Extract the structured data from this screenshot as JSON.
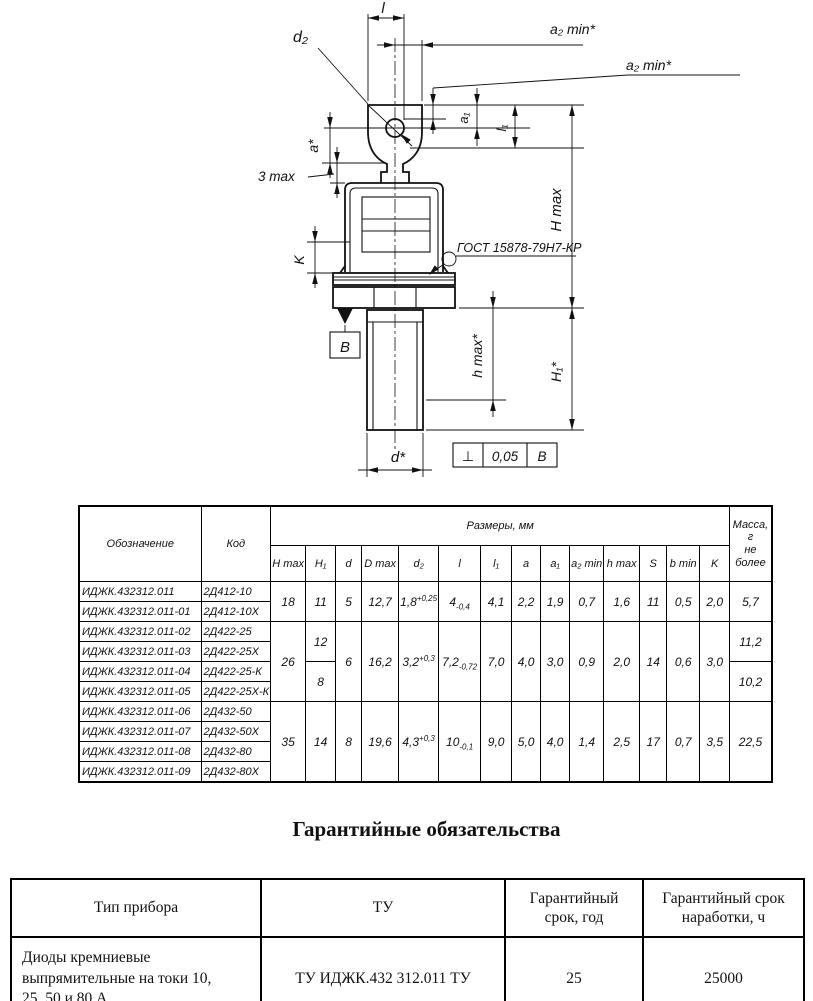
{
  "drawing": {
    "labels": {
      "l": "l",
      "a2_min_top": "a₂ min*",
      "a2_min_side": "a₂ min*",
      "d2": "d₂",
      "a1": "a₁",
      "l1": "l₁",
      "a_star": "a*",
      "three_max": "3 max",
      "k": "K",
      "gost": "ГОСТ 15878-79Н7-КР",
      "datum_b": "В",
      "h_max_star": "h max*",
      "h1_star": "H₁*",
      "h_max_total": "H max",
      "d_star": "d*"
    },
    "tolerance_frame": {
      "symbol": "⊥",
      "value": "0,05",
      "datum": "В"
    }
  },
  "dims_table": {
    "headers": {
      "designation": "Обозначение",
      "code": "Код",
      "sizes": "Размеры, мм",
      "mass": "Масса, г\nне более",
      "columns": [
        "H max",
        "H₁",
        "d",
        "D max",
        "d₂",
        "l",
        "l₁",
        "a",
        "a₁",
        "a₂ min",
        "h max",
        "S",
        "b min",
        "K"
      ]
    },
    "col_widths": [
      122,
      56,
      35,
      30,
      26,
      37,
      40,
      42,
      31,
      29,
      29,
      33,
      36,
      27,
      33,
      30,
      42
    ],
    "rows": [
      {
        "cells": [
          {
            "t": "ИДЖК.432312.011"
          },
          {
            "t": "2Д412-10"
          },
          {
            "t": "18",
            "rs": 2
          },
          {
            "t": "11",
            "rs": 2
          },
          {
            "t": "5",
            "rs": 2
          },
          {
            "t": "12,7",
            "rs": 2
          },
          {
            "t": "1,8",
            "sup": "+0,25",
            "rs": 2
          },
          {
            "t": "4",
            "sub": "-0,4",
            "rs": 2
          },
          {
            "t": "4,1",
            "rs": 2
          },
          {
            "t": "2,2",
            "rs": 2
          },
          {
            "t": "1,9",
            "rs": 2
          },
          {
            "t": "0,7",
            "rs": 2
          },
          {
            "t": "1,6",
            "rs": 2
          },
          {
            "t": "11",
            "rs": 2
          },
          {
            "t": "0,5",
            "rs": 2
          },
          {
            "t": "2,0",
            "rs": 2
          },
          {
            "t": "5,7",
            "rs": 2
          }
        ]
      },
      {
        "cells": [
          {
            "t": "ИДЖК.432312.011-01"
          },
          {
            "t": "2Д412-10Х"
          }
        ]
      },
      {
        "cells": [
          {
            "t": "ИДЖК.432312.011-02"
          },
          {
            "t": "2Д422-25"
          },
          {
            "t": "26",
            "rs": 4
          },
          {
            "t": "12",
            "rs": 2
          },
          {
            "t": "6",
            "rs": 4
          },
          {
            "t": "16,2",
            "rs": 4
          },
          {
            "t": "3,2",
            "sup": "+0,3",
            "rs": 4
          },
          {
            "t": "7,2",
            "sub": "-0,72",
            "rs": 4
          },
          {
            "t": "7,0",
            "rs": 4
          },
          {
            "t": "4,0",
            "rs": 4
          },
          {
            "t": "3,0",
            "rs": 4
          },
          {
            "t": "0,9",
            "rs": 4
          },
          {
            "t": "2,0",
            "rs": 4
          },
          {
            "t": "14",
            "rs": 4
          },
          {
            "t": "0,6",
            "rs": 4
          },
          {
            "t": "3,0",
            "rs": 4
          },
          {
            "t": "11,2",
            "rs": 2
          }
        ]
      },
      {
        "cells": [
          {
            "t": "ИДЖК.432312.011-03"
          },
          {
            "t": "2Д422-25Х"
          }
        ]
      },
      {
        "cells": [
          {
            "t": "ИДЖК.432312.011-04"
          },
          {
            "t": "2Д422-25-К"
          },
          {
            "t": "8",
            "rs": 2
          },
          {
            "t": "10,2",
            "rs": 2
          }
        ]
      },
      {
        "cells": [
          {
            "t": "ИДЖК.432312.011-05"
          },
          {
            "t": "2Д422-25Х-К"
          }
        ]
      },
      {
        "cells": [
          {
            "t": "ИДЖК.432312.011-06"
          },
          {
            "t": "2Д432-50"
          },
          {
            "t": "35",
            "rs": 4
          },
          {
            "t": "14",
            "rs": 4
          },
          {
            "t": "8",
            "rs": 4
          },
          {
            "t": "19,6",
            "rs": 4
          },
          {
            "t": "4,3",
            "sup": "+0,3",
            "rs": 4
          },
          {
            "t": "10",
            "sub": "-0,1",
            "rs": 4
          },
          {
            "t": "9,0",
            "rs": 4
          },
          {
            "t": "5,0",
            "rs": 4
          },
          {
            "t": "4,0",
            "rs": 4
          },
          {
            "t": "1,4",
            "rs": 4
          },
          {
            "t": "2,5",
            "rs": 4
          },
          {
            "t": "17",
            "rs": 4
          },
          {
            "t": "0,7",
            "rs": 4
          },
          {
            "t": "3,5",
            "rs": 4
          },
          {
            "t": "22,5",
            "rs": 4
          }
        ]
      },
      {
        "cells": [
          {
            "t": "ИДЖК.432312.011-07"
          },
          {
            "t": "2Д432-50Х"
          }
        ]
      },
      {
        "cells": [
          {
            "t": "ИДЖК.432312.011-08"
          },
          {
            "t": "2Д432-80"
          }
        ]
      },
      {
        "cells": [
          {
            "t": "ИДЖК.432312.011-09"
          },
          {
            "t": "2Д432-80Х"
          }
        ]
      }
    ]
  },
  "warranty": {
    "heading": "Гарантийные обязательства",
    "table": {
      "headers": [
        "Тип прибора",
        "ТУ",
        "Гарантийный срок, год",
        "Гарантийный срок наработки, ч"
      ],
      "rows": [
        [
          "Диоды кремниевые выпрямительные на токи 10, 25, 50 и 80 А",
          "ТУ ИДЖК.432 312.011 ТУ",
          "25",
          "25000"
        ]
      ]
    }
  }
}
